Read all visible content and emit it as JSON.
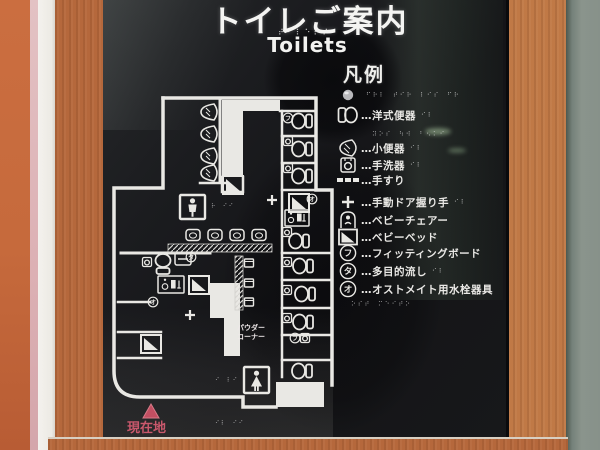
{
  "sign": {
    "title": "トイレご案内",
    "subtitle": "Toilets",
    "legend": {
      "header": "凡例",
      "items": [
        {
          "name": "tactile-dot",
          "label": ""
        },
        {
          "name": "western-toilet",
          "label": "…洋式便器"
        },
        {
          "name": "urinal",
          "label": "…小便器"
        },
        {
          "name": "hand-wash-basin",
          "label": "…手洗器"
        },
        {
          "name": "handrail",
          "label": "…手すり"
        },
        {
          "name": "manual-door-handle",
          "label": "…手動ドア握り手"
        },
        {
          "name": "baby-chair",
          "label": "…ベビーチェアー"
        },
        {
          "name": "baby-bed",
          "label": "…ベビーベッド"
        },
        {
          "name": "fitting-board",
          "label": "…フィッティングボード",
          "symbol": "フ"
        },
        {
          "name": "multipurpose-sink",
          "label": "…多目的流し",
          "symbol": "タ"
        },
        {
          "name": "ostomate-fixture",
          "label": "…オストメイト用水栓器具",
          "symbol": "オ"
        }
      ]
    },
    "map": {
      "powder_corner_line1": "パウダー",
      "powder_corner_line2": "コーナー",
      "current_location": "現在地",
      "symbols": {
        "fitting": "フ",
        "sink": "タ",
        "ostomate": "オ"
      }
    },
    "braille": {
      "title_row": "⠞⠊⠇⠑⠞⠎",
      "legend_row1": "⠋⠗⠇⠀⠞⠊⠗⠀⠇⠊⠎⠀⠋⠗",
      "legend_row2": "⠽⠕⠎⠀⠳⠺⠀⠃⠢⠅⠊",
      "legend_row3": "⠕⠎⠞⠀⠍⠑⠊⠞⠕",
      "small": "⠊⠇",
      "map1": "⠗⠀⠊⠊",
      "map2": "⠊⠇⠀⠊⠊",
      "map3": "⠊⠀⠇⠊"
    }
  },
  "colors": {
    "frame_orange": "#c86b3e",
    "frame_pink": "#dcb0b4",
    "frame_white": "#f2f0ec",
    "wood": "#b5683c",
    "wall_gray": "#8a948c",
    "sign_background": "#17171a",
    "map_line_white": "#e9e8e4",
    "current_location_red": "#c9586c"
  }
}
